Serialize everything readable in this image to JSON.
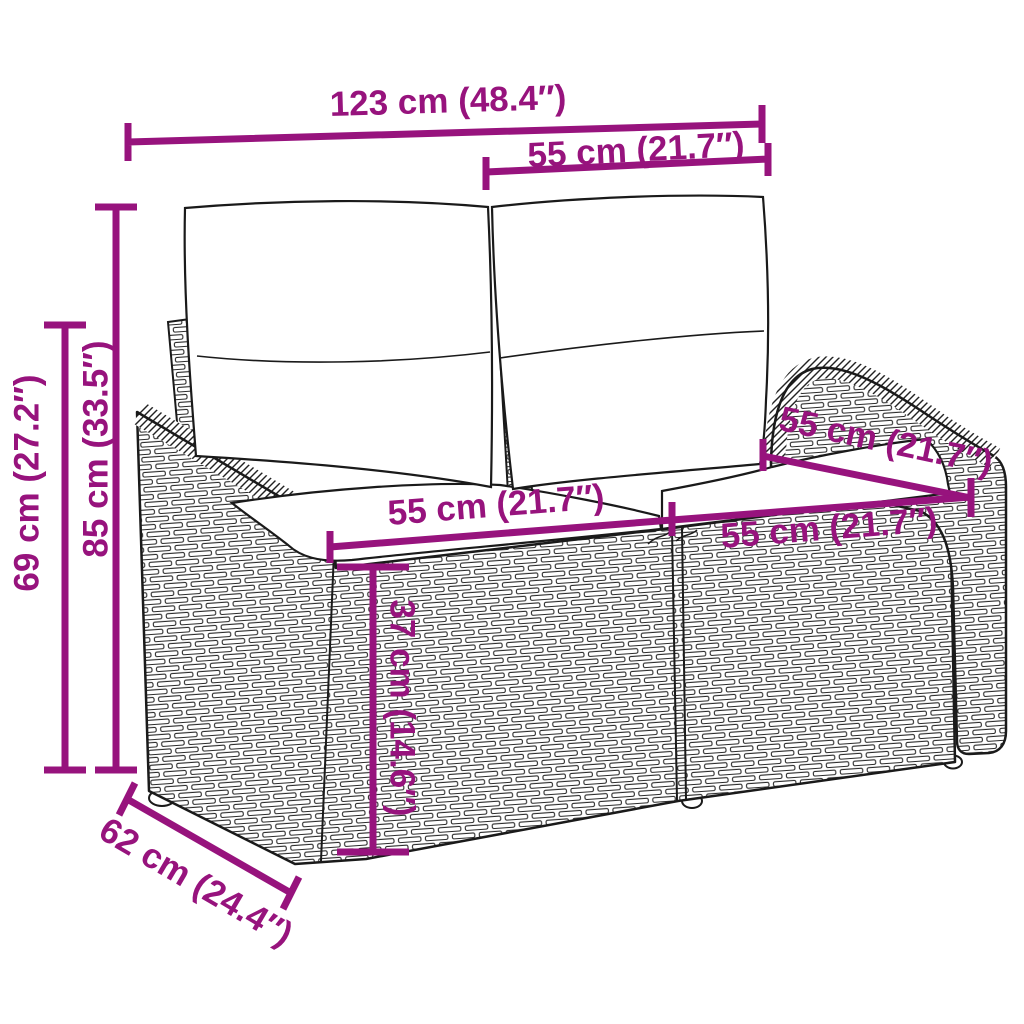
{
  "diagram": {
    "description": "Dimension diagram of a poly rattan two-seater garden sofa with back and seat cushions",
    "style": {
      "accent_color": "#97137D",
      "outline_color": "#1a1a1a",
      "background_color": "#ffffff"
    },
    "dimensions": {
      "overall_width": {
        "label": "123 cm (48.4″)"
      },
      "back_cushion_width": {
        "label": "55 cm (21.7″)"
      },
      "total_height": {
        "label": "85 cm (33.5″)"
      },
      "arm_height": {
        "label": "69 cm (27.2″)"
      },
      "seat_depth_right": {
        "label": "55 cm (21.7″)"
      },
      "seat_width_left": {
        "label": "55 cm (21.7″)"
      },
      "seat_width_right": {
        "label": "55 cm (21.7″)"
      },
      "seat_height": {
        "label": "37 cm (14.6″)"
      },
      "overall_depth": {
        "label": "62 cm (24.4″)"
      }
    }
  }
}
